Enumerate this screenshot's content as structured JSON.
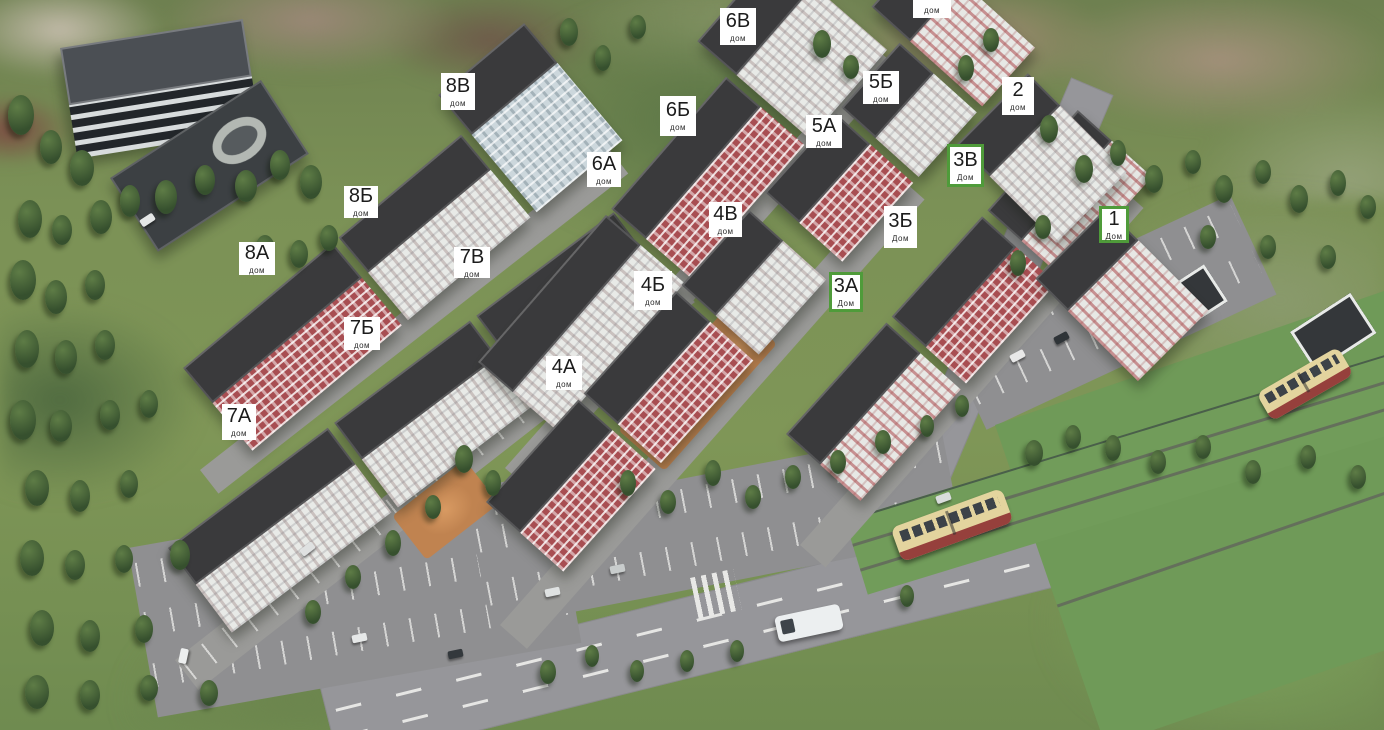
{
  "view": {
    "type": "residential-complex-master-plan",
    "marker_sub_label_lower": "дом",
    "marker_sub_label_upper": "Дом"
  },
  "palette": {
    "label_bg": "#ffffff",
    "label_text": "#1c1c1c",
    "label_highlight_border": "#4f9b3a",
    "building_red": "#a84e52",
    "building_white": "#e8eae7",
    "building_blue": "#ccd7dc",
    "roof_dark": "#3a3a3c",
    "grass": "#7b9156",
    "road": "#96969a",
    "playground_orange": "#c08350",
    "tree_green": "#3d5a35",
    "tram_body": "#e3d49e",
    "tram_skirt": "#96403c"
  },
  "labels": [
    {
      "name": "5В",
      "sub": "дом",
      "highlighted": false,
      "x": 913,
      "y": -20,
      "w": 38,
      "h": 38
    },
    {
      "name": "6В",
      "sub": "дом",
      "highlighted": false,
      "x": 720,
      "y": 8,
      "w": 36,
      "h": 37
    },
    {
      "name": "8В",
      "sub": "дом",
      "highlighted": false,
      "x": 441,
      "y": 73,
      "w": 34,
      "h": 37
    },
    {
      "name": "5Б",
      "sub": "дом",
      "highlighted": false,
      "x": 863,
      "y": 71,
      "w": 36,
      "h": 33
    },
    {
      "name": "2",
      "sub": "дом",
      "highlighted": false,
      "x": 1002,
      "y": 77,
      "w": 32,
      "h": 38
    },
    {
      "name": "6Б",
      "sub": "дом",
      "highlighted": false,
      "x": 660,
      "y": 96,
      "w": 36,
      "h": 40
    },
    {
      "name": "5А",
      "sub": "дом",
      "highlighted": false,
      "x": 806,
      "y": 115,
      "w": 36,
      "h": 33
    },
    {
      "name": "3В",
      "sub": "Дом",
      "highlighted": true,
      "x": 947,
      "y": 144,
      "w": 37,
      "h": 43
    },
    {
      "name": "6А",
      "sub": "дом",
      "highlighted": false,
      "x": 587,
      "y": 152,
      "w": 34,
      "h": 35
    },
    {
      "name": "8Б",
      "sub": "дом",
      "highlighted": false,
      "x": 344,
      "y": 186,
      "w": 34,
      "h": 32
    },
    {
      "name": "4В",
      "sub": "дом",
      "highlighted": false,
      "x": 709,
      "y": 202,
      "w": 33,
      "h": 35
    },
    {
      "name": "3Б",
      "sub": "Дом",
      "highlighted": false,
      "x": 884,
      "y": 206,
      "w": 33,
      "h": 42
    },
    {
      "name": "1",
      "sub": "Дом",
      "highlighted": true,
      "x": 1099,
      "y": 206,
      "w": 30,
      "h": 37
    },
    {
      "name": "8А",
      "sub": "дом",
      "highlighted": false,
      "x": 239,
      "y": 242,
      "w": 36,
      "h": 33
    },
    {
      "name": "7В",
      "sub": "дом",
      "highlighted": false,
      "x": 454,
      "y": 247,
      "w": 36,
      "h": 31
    },
    {
      "name": "4Б",
      "sub": "дом",
      "highlighted": false,
      "x": 634,
      "y": 271,
      "w": 38,
      "h": 39
    },
    {
      "name": "3А",
      "sub": "Дом",
      "highlighted": true,
      "x": 829,
      "y": 272,
      "w": 34,
      "h": 40
    },
    {
      "name": "7Б",
      "sub": "дом",
      "highlighted": false,
      "x": 344,
      "y": 317,
      "w": 36,
      "h": 33
    },
    {
      "name": "4А",
      "sub": "дом",
      "highlighted": false,
      "x": 546,
      "y": 356,
      "w": 36,
      "h": 34
    },
    {
      "name": "7А",
      "sub": "дом",
      "highlighted": false,
      "x": 222,
      "y": 404,
      "w": 34,
      "h": 36
    }
  ]
}
